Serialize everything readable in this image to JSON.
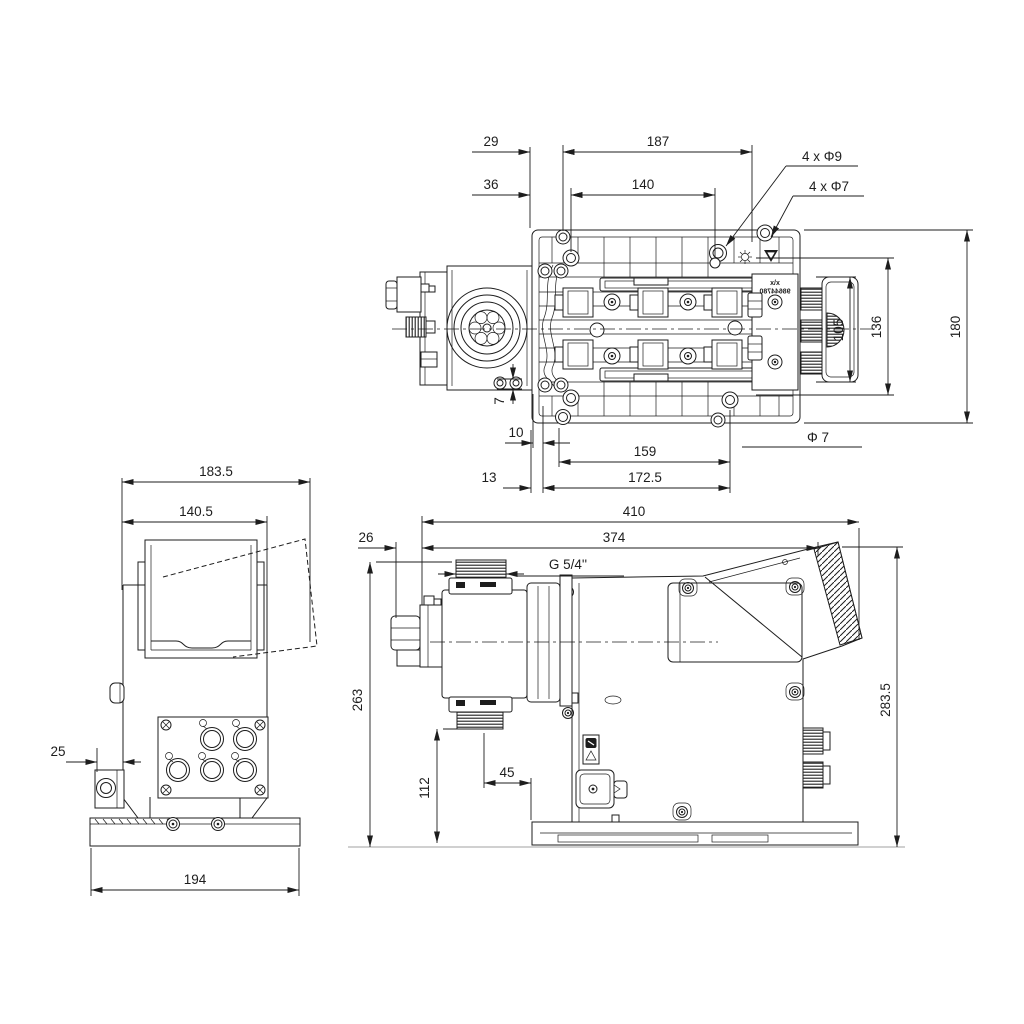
{
  "drawing": {
    "type": "technical dimensional drawing, dosing pump, three orthographic views",
    "background": "#ffffff",
    "ink_color": "#1d1d1d"
  },
  "top_view": {
    "dims": {
      "d29": "29",
      "d187": "187",
      "d36": "36",
      "d140": "140",
      "holes9": "4 x Φ9",
      "holes7": "4 x Φ7",
      "d105": "105",
      "d136": "136",
      "d180": "180",
      "d7": "7",
      "d10": "10",
      "d13": "13",
      "d159": "159",
      "d172_5": "172.5",
      "dia7": "Φ 7"
    },
    "label": {
      "line1": "x/x",
      "line2": "98644780"
    }
  },
  "front_view": {
    "dims": {
      "d183_5": "183.5",
      "d140_5": "140.5",
      "d25": "25",
      "d194": "194"
    }
  },
  "side_view": {
    "dims": {
      "d410": "410",
      "d374": "374",
      "d26": "26",
      "thread": "G 5/4''",
      "d263": "263",
      "d283_5": "283.5",
      "d112": "112",
      "d45": "45"
    }
  }
}
